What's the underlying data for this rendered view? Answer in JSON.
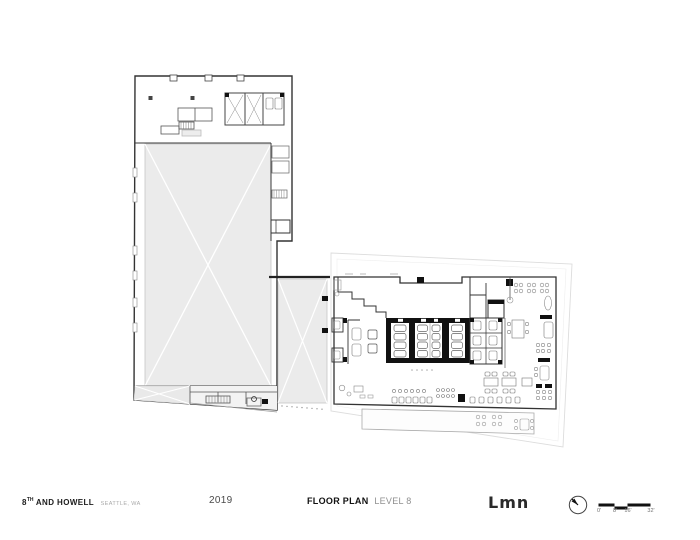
{
  "footer": {
    "project": {
      "number": "8",
      "ordinal": "TH",
      "name": "AND HOWELL",
      "location": "SEATTLE, WA"
    },
    "year": "2019",
    "drawing": {
      "title": "FLOOR PLAN",
      "level": "LEVEL 8"
    },
    "firm": {
      "logo_text": "Lmn"
    }
  },
  "north_arrow": {
    "icon": "compass-needle",
    "direction": "northwest"
  },
  "scale_bar": {
    "labels": [
      "0'",
      "8'",
      "16'",
      "32'"
    ]
  },
  "colors": {
    "wall": "#3a3a3a",
    "heavy_wall": "#111111",
    "shaded_area": "#ebebeb",
    "faint_line": "#dddddd",
    "background": "#ffffff"
  }
}
